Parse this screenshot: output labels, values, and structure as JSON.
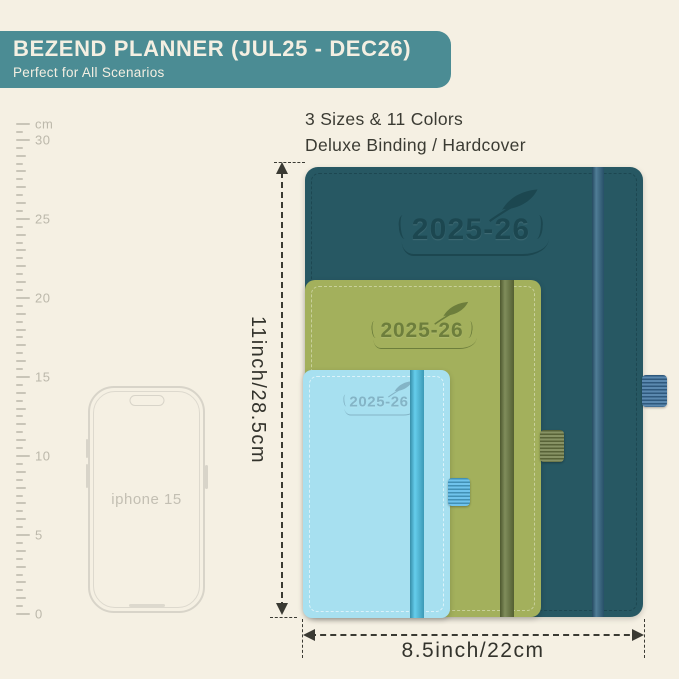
{
  "banner": {
    "title": "BEZEND PLANNER (JUL25 - DEC26)",
    "subtitle": "Perfect for All Scenarios",
    "bg_color": "#4b8c94",
    "text_color": "#f4efe2"
  },
  "features": {
    "line1": "3 Sizes & 11 Colors",
    "line2": "Deluxe Binding / Hardcover"
  },
  "ruler": {
    "unit": "cm",
    "numbers": [
      "30",
      "25",
      "20",
      "15",
      "10",
      "5",
      "0"
    ],
    "max_cm": 31,
    "px_per_cm": 15.81
  },
  "phone": {
    "label": "iphone 15"
  },
  "planners": [
    {
      "size": "large",
      "year": "2025-26",
      "cover": "#275863",
      "band": "#336785",
      "loop": "#3c72a0",
      "stitch": "#1c454f",
      "emboss": "#1c4750"
    },
    {
      "size": "medium",
      "year": "2025-26",
      "cover": "#a3b05c",
      "band": "#6b7a40",
      "loop": "#707d46",
      "stitch": "#cfd6a6",
      "emboss": "#6d7e3c"
    },
    {
      "size": "small",
      "year": "2025-26",
      "cover": "#a7e0f0",
      "band": "#4cc5e9",
      "loop": "#55b8e8",
      "stitch": "#e5f6fb",
      "emboss": "#84b4c6"
    }
  ],
  "dimensions": {
    "height_label": "11inch/28.5cm",
    "width_label": "8.5inch/22cm"
  }
}
